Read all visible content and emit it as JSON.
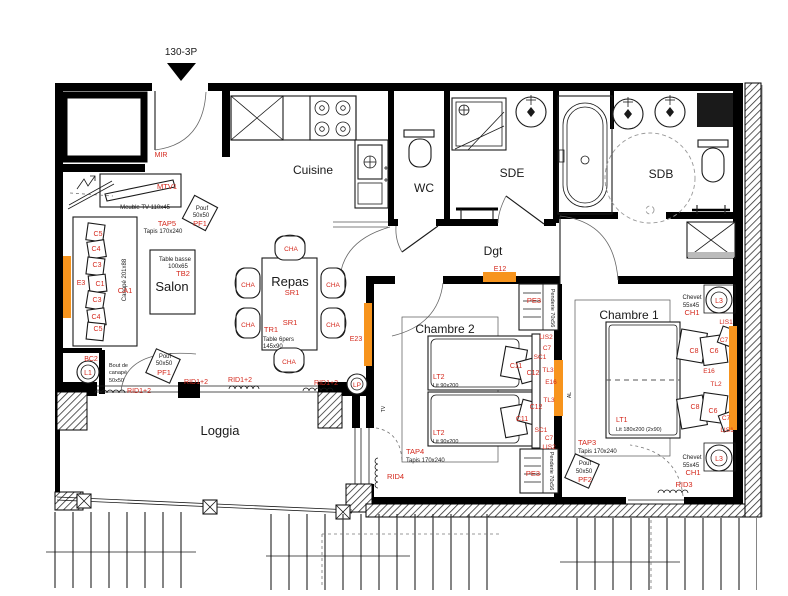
{
  "title": "130-3P",
  "palette": {
    "red": "#d4281c",
    "orange": "#F7941D",
    "ink": "#1a1a1a",
    "wall": "#000000"
  },
  "rooms": [
    "Cuisine",
    "WC",
    "SDE",
    "SDB",
    "Dgt",
    "Salon",
    "Repas",
    "Chambre 2",
    "Chambre 1",
    "Loggia"
  ],
  "labels": [
    {
      "t": "130-3P",
      "x": 181,
      "y": 55,
      "k": "blk",
      "fs": 10
    },
    {
      "t": "Cuisine",
      "x": 313,
      "y": 174,
      "k": "room",
      "fs": 12
    },
    {
      "t": "WC",
      "x": 424,
      "y": 192,
      "k": "room",
      "fs": 12
    },
    {
      "t": "SDE",
      "x": 512,
      "y": 177,
      "k": "room",
      "fs": 12
    },
    {
      "t": "SDB",
      "x": 661,
      "y": 178,
      "k": "room",
      "fs": 12
    },
    {
      "t": "Dgt",
      "x": 493,
      "y": 255,
      "k": "room",
      "fs": 12
    },
    {
      "t": "Salon",
      "x": 172,
      "y": 291,
      "k": "room",
      "fs": 13
    },
    {
      "t": "Repas",
      "x": 290,
      "y": 286,
      "k": "room",
      "fs": 13
    },
    {
      "t": "Chambre 2",
      "x": 445,
      "y": 333,
      "k": "room",
      "fs": 12
    },
    {
      "t": "Chambre 1",
      "x": 629,
      "y": 319,
      "k": "room",
      "fs": 12
    },
    {
      "t": "Loggia",
      "x": 220,
      "y": 435,
      "k": "room",
      "fs": 13
    },
    {
      "t": "MIR",
      "x": 161,
      "y": 157,
      "k": "red",
      "fs": 7
    },
    {
      "t": "MTV1",
      "x": 167,
      "y": 189,
      "k": "red",
      "fs": 7.5
    },
    {
      "t": "Meuble TV 110x45",
      "x": 145,
      "y": 209,
      "k": "blk",
      "fs": 6
    },
    {
      "t": "Pouf",
      "x": 202,
      "y": 210,
      "k": "blk",
      "fs": 6
    },
    {
      "t": "50x50",
      "x": 201,
      "y": 217,
      "k": "blk",
      "fs": 6
    },
    {
      "t": "PF1",
      "x": 200,
      "y": 226,
      "k": "red",
      "fs": 7.5
    },
    {
      "t": "TAP5",
      "x": 167,
      "y": 226,
      "k": "red",
      "fs": 7.5
    },
    {
      "t": "Tapis 170x240",
      "x": 163,
      "y": 233,
      "k": "blk",
      "fs": 6
    },
    {
      "t": "C5",
      "x": 98,
      "y": 236,
      "k": "red",
      "fs": 7
    },
    {
      "t": "C4",
      "x": 96,
      "y": 251,
      "k": "red",
      "fs": 7
    },
    {
      "t": "C3",
      "x": 97,
      "y": 267,
      "k": "red",
      "fs": 7
    },
    {
      "t": "C1",
      "x": 100,
      "y": 286,
      "k": "red",
      "fs": 7
    },
    {
      "t": "C3",
      "x": 97,
      "y": 302,
      "k": "red",
      "fs": 7
    },
    {
      "t": "C4",
      "x": 96,
      "y": 319,
      "k": "red",
      "fs": 7
    },
    {
      "t": "C5",
      "x": 98,
      "y": 331,
      "k": "red",
      "fs": 7
    },
    {
      "t": "Canapé 201x88",
      "x": 126,
      "y": 280,
      "k": "blk",
      "fs": 6,
      "rot": -90
    },
    {
      "t": "CA1",
      "x": 125,
      "y": 293,
      "k": "red",
      "fs": 7.5
    },
    {
      "t": "E3",
      "x": 81,
      "y": 285,
      "k": "red",
      "fs": 7
    },
    {
      "t": "Table basse",
      "x": 175,
      "y": 261,
      "k": "blk",
      "fs": 6
    },
    {
      "t": "100x65",
      "x": 178,
      "y": 268,
      "k": "blk",
      "fs": 6
    },
    {
      "t": "TB2",
      "x": 183,
      "y": 276,
      "k": "red",
      "fs": 7.5
    },
    {
      "t": "BC2",
      "x": 91,
      "y": 361,
      "k": "red",
      "fs": 7
    },
    {
      "t": "L1",
      "x": 88,
      "y": 375,
      "k": "red",
      "fs": 7
    },
    {
      "t": "Bout de",
      "x": 109,
      "y": 367,
      "k": "blk",
      "fs": 5.5,
      "a": "start"
    },
    {
      "t": "canapé",
      "x": 109,
      "y": 374,
      "k": "blk",
      "fs": 5.5,
      "a": "start"
    },
    {
      "t": "50x50",
      "x": 109,
      "y": 382,
      "k": "blk",
      "fs": 5.5,
      "a": "start"
    },
    {
      "t": "Pouf",
      "x": 165,
      "y": 358,
      "k": "blk",
      "fs": 6
    },
    {
      "t": "50x50",
      "x": 164,
      "y": 365,
      "k": "blk",
      "fs": 6
    },
    {
      "t": "PF1",
      "x": 164,
      "y": 375,
      "k": "red",
      "fs": 7.5
    },
    {
      "t": "RID1+2",
      "x": 139,
      "y": 393,
      "k": "red",
      "fs": 7
    },
    {
      "t": "RID1+2",
      "x": 196,
      "y": 384,
      "k": "red",
      "fs": 7
    },
    {
      "t": "RID1+2",
      "x": 240,
      "y": 382,
      "k": "red",
      "fs": 7
    },
    {
      "t": "RID1+2",
      "x": 326,
      "y": 385,
      "k": "red",
      "fs": 7
    },
    {
      "t": "LP",
      "x": 357,
      "y": 387,
      "k": "red",
      "fs": 6.5
    },
    {
      "t": "CHA",
      "x": 291,
      "y": 251,
      "k": "red",
      "fs": 6.5
    },
    {
      "t": "CHA",
      "x": 248,
      "y": 287,
      "k": "red",
      "fs": 6.5
    },
    {
      "t": "CHA",
      "x": 333,
      "y": 287,
      "k": "red",
      "fs": 6.5
    },
    {
      "t": "CHA",
      "x": 248,
      "y": 327,
      "k": "red",
      "fs": 6.5
    },
    {
      "t": "CHA",
      "x": 333,
      "y": 327,
      "k": "red",
      "fs": 6.5
    },
    {
      "t": "CHA",
      "x": 289,
      "y": 364,
      "k": "red",
      "fs": 6.5
    },
    {
      "t": "SR1",
      "x": 292,
      "y": 295,
      "k": "red",
      "fs": 7.5
    },
    {
      "t": "SR1",
      "x": 290,
      "y": 325,
      "k": "red",
      "fs": 7.5
    },
    {
      "t": "TR1",
      "x": 271,
      "y": 332,
      "k": "red",
      "fs": 7.5
    },
    {
      "t": "Table 6pers",
      "x": 263,
      "y": 341,
      "k": "blk",
      "fs": 6,
      "a": "start"
    },
    {
      "t": "145x90",
      "x": 263,
      "y": 348,
      "k": "blk",
      "fs": 6,
      "a": "start"
    },
    {
      "t": "E23",
      "x": 356,
      "y": 341,
      "k": "red",
      "fs": 7
    },
    {
      "t": "E12",
      "x": 500,
      "y": 271,
      "k": "red",
      "fs": 7
    },
    {
      "t": "PE3",
      "x": 534,
      "y": 303,
      "k": "red",
      "fs": 7.5
    },
    {
      "t": "Penderie 70x56",
      "x": 551,
      "y": 308,
      "k": "blk",
      "fs": 5.5,
      "rot": 90
    },
    {
      "t": "LIS2",
      "x": 546,
      "y": 339,
      "k": "red",
      "fs": 6.5
    },
    {
      "t": "C7",
      "x": 547,
      "y": 350,
      "k": "red",
      "fs": 6.5
    },
    {
      "t": "SC1",
      "x": 540,
      "y": 359,
      "k": "red",
      "fs": 6.5
    },
    {
      "t": "C11",
      "x": 516,
      "y": 368,
      "k": "red",
      "fs": 7
    },
    {
      "t": "C12",
      "x": 533,
      "y": 375,
      "k": "red",
      "fs": 7
    },
    {
      "t": "TL3",
      "x": 548,
      "y": 372,
      "k": "red",
      "fs": 6.5
    },
    {
      "t": "E16",
      "x": 551,
      "y": 384,
      "k": "red",
      "fs": 6.5
    },
    {
      "t": "LT2",
      "x": 433,
      "y": 379,
      "k": "red",
      "fs": 7,
      "a": "start"
    },
    {
      "t": "Lit 90x200",
      "x": 433,
      "y": 387,
      "k": "blk",
      "fs": 5.5,
      "a": "start"
    },
    {
      "t": "TL3",
      "x": 549,
      "y": 402,
      "k": "red",
      "fs": 6.5
    },
    {
      "t": "C12",
      "x": 536,
      "y": 409,
      "k": "red",
      "fs": 7
    },
    {
      "t": "C11",
      "x": 522,
      "y": 421,
      "k": "red",
      "fs": 7
    },
    {
      "t": "SC1",
      "x": 541,
      "y": 432,
      "k": "red",
      "fs": 6.5
    },
    {
      "t": "C7",
      "x": 549,
      "y": 440,
      "k": "red",
      "fs": 6.5
    },
    {
      "t": "LIS2",
      "x": 549,
      "y": 449,
      "k": "red",
      "fs": 6.5
    },
    {
      "t": "LT2",
      "x": 433,
      "y": 435,
      "k": "red",
      "fs": 7,
      "a": "start"
    },
    {
      "t": "Lit 90x200",
      "x": 433,
      "y": 443,
      "k": "blk",
      "fs": 5.5,
      "a": "start"
    },
    {
      "t": "TAP4",
      "x": 406,
      "y": 454,
      "k": "red",
      "fs": 7.5,
      "a": "start"
    },
    {
      "t": "Tapis 170x240",
      "x": 406,
      "y": 462,
      "k": "blk",
      "fs": 6,
      "a": "start"
    },
    {
      "t": "RID4",
      "x": 387,
      "y": 479,
      "k": "red",
      "fs": 7.5,
      "a": "start"
    },
    {
      "t": "PE3",
      "x": 533,
      "y": 476,
      "k": "red",
      "fs": 7.5
    },
    {
      "t": "Penderie 70x56",
      "x": 550,
      "y": 471,
      "k": "blk",
      "fs": 5.5,
      "rot": 90
    },
    {
      "t": "TV",
      "x": 385,
      "y": 409,
      "k": "blk",
      "fs": 5,
      "rot": -90
    },
    {
      "t": "AL",
      "x": 571,
      "y": 395,
      "k": "blk",
      "fs": 5,
      "rot": -90
    },
    {
      "t": "Chevet",
      "x": 692,
      "y": 299,
      "k": "blk",
      "fs": 6
    },
    {
      "t": "55x45",
      "x": 691,
      "y": 307,
      "k": "blk",
      "fs": 6
    },
    {
      "t": "CH1",
      "x": 692,
      "y": 315,
      "k": "red",
      "fs": 7.5
    },
    {
      "t": "L3",
      "x": 719,
      "y": 303,
      "k": "red",
      "fs": 7
    },
    {
      "t": "LIS1",
      "x": 726,
      "y": 324,
      "k": "red",
      "fs": 6.5
    },
    {
      "t": "C7",
      "x": 724,
      "y": 342,
      "k": "red",
      "fs": 6.5
    },
    {
      "t": "C8",
      "x": 694,
      "y": 353,
      "k": "red",
      "fs": 7
    },
    {
      "t": "C6",
      "x": 714,
      "y": 353,
      "k": "red",
      "fs": 7
    },
    {
      "t": "E16",
      "x": 709,
      "y": 373,
      "k": "red",
      "fs": 6.5
    },
    {
      "t": "TL2",
      "x": 716,
      "y": 386,
      "k": "red",
      "fs": 6.5
    },
    {
      "t": "C8",
      "x": 695,
      "y": 409,
      "k": "red",
      "fs": 7
    },
    {
      "t": "C6",
      "x": 713,
      "y": 413,
      "k": "red",
      "fs": 7
    },
    {
      "t": "C7",
      "x": 726,
      "y": 420,
      "k": "red",
      "fs": 6.5
    },
    {
      "t": "LIS1",
      "x": 727,
      "y": 432,
      "k": "red",
      "fs": 6.5
    },
    {
      "t": "LT1",
      "x": 616,
      "y": 422,
      "k": "red",
      "fs": 7,
      "a": "start"
    },
    {
      "t": "Lit 180x200 (2x90)",
      "x": 616,
      "y": 431,
      "k": "blk",
      "fs": 5.5,
      "a": "start"
    },
    {
      "t": "TAP3",
      "x": 578,
      "y": 445,
      "k": "red",
      "fs": 7.5,
      "a": "start"
    },
    {
      "t": "Tapis 170x240",
      "x": 578,
      "y": 453,
      "k": "blk",
      "fs": 6,
      "a": "start"
    },
    {
      "t": "Pouf",
      "x": 585,
      "y": 465,
      "k": "blk",
      "fs": 6
    },
    {
      "t": "50x50",
      "x": 584,
      "y": 473,
      "k": "blk",
      "fs": 6
    },
    {
      "t": "PF2",
      "x": 585,
      "y": 482,
      "k": "red",
      "fs": 7.5
    },
    {
      "t": "Chevet",
      "x": 692,
      "y": 459,
      "k": "blk",
      "fs": 6
    },
    {
      "t": "55x45",
      "x": 691,
      "y": 467,
      "k": "blk",
      "fs": 6
    },
    {
      "t": "CH1",
      "x": 693,
      "y": 475,
      "k": "red",
      "fs": 7.5
    },
    {
      "t": "L3",
      "x": 719,
      "y": 461,
      "k": "red",
      "fs": 7
    },
    {
      "t": "RID3",
      "x": 684,
      "y": 487,
      "k": "red",
      "fs": 7.5
    }
  ]
}
